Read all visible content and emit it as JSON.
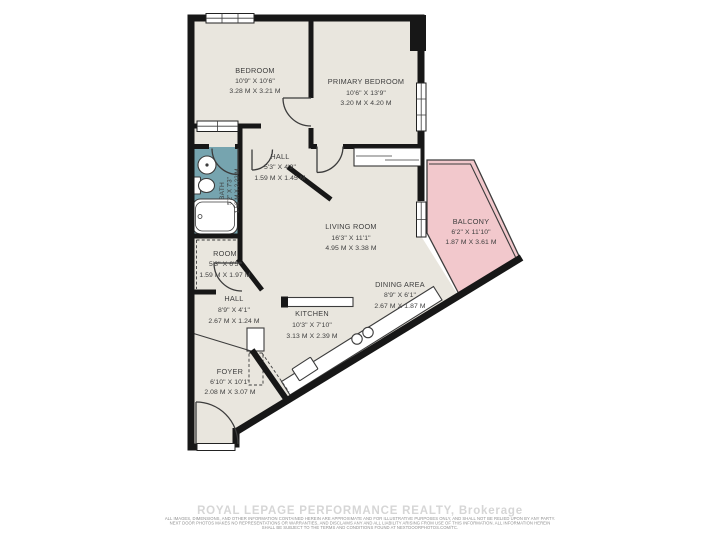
{
  "rooms": [
    {
      "id": "bedroom",
      "name": "BEDROOM",
      "imperial": "10'9\" X 10'6\"",
      "metric": "3.28 M X 3.21 M"
    },
    {
      "id": "primary-bedroom",
      "name": "PRIMARY BEDROOM",
      "imperial": "10'6\" X 13'9\"",
      "metric": "3.20 M X 4.20 M"
    },
    {
      "id": "hall-upper",
      "name": "HALL",
      "imperial": "5'3\" X 4'9\"",
      "metric": "1.59 M X 1.45 M"
    },
    {
      "id": "bath",
      "name": "BATH",
      "imperial": "5'2\" X 7'3\"",
      "metric": "1.58 M X 2.22 M"
    },
    {
      "id": "room",
      "name": "ROOM",
      "imperial": "5'3\" X 6'5\"",
      "metric": "1.59 M X 1.97 M"
    },
    {
      "id": "living-room",
      "name": "LIVING ROOM",
      "imperial": "16'3\" X 11'1\"",
      "metric": "4.95 M X 3.38 M"
    },
    {
      "id": "balcony",
      "name": "BALCONY",
      "imperial": "6'2\" X 11'10\"",
      "metric": "1.87 M X 3.61 M"
    },
    {
      "id": "dining-area",
      "name": "DINING AREA",
      "imperial": "8'9\" X 6'1\"",
      "metric": "2.67 M X 1.87 M"
    },
    {
      "id": "kitchen",
      "name": "KITCHEN",
      "imperial": "10'3\" X 7'10\"",
      "metric": "3.13 M X 2.39 M"
    },
    {
      "id": "hall-lower",
      "name": "HALL",
      "imperial": "8'9\" X 4'1\"",
      "metric": "2.67 M X 1.24 M"
    },
    {
      "id": "foyer",
      "name": "FOYER",
      "imperial": "6'10\" X 10'1\"",
      "metric": "2.08 M X 3.07 M"
    }
  ],
  "footer": {
    "brokerage": "ROYAL LEPAGE PERFORMANCE REALTY, Brokerage",
    "disclaimer_line1": "ALL IMAGES, DIMENSIONS, AND OTHER INFORMATION CONTAINED HEREIN ARE APPROXIMATE AND FOR ILLUSTRATIVE PURPOSES ONLY, AND SHALL NOT BE RELIED UPON BY ANY PARTY.",
    "disclaimer_line2": "NEXT DOOR PHOTOS MAKES NO REPRESENTATIONS OR WARRANTIES, AND DISCLAIMS ANY AND ALL LIABILITY ARISING FROM USE OF THIS INFORMATION. ALL INFORMATION HEREIN",
    "disclaimer_line3": "SHALL BE SUBJECT TO THE TERMS AND CONDITIONS FOUND AT NEXTDOORPHOTOS.COM/TC."
  },
  "colors": {
    "floor": "#e9e6de",
    "balcony": "#f2c8cc",
    "bath": "#76a4af",
    "wall": "#171717",
    "ink": "#3e3e3e",
    "brokerage": "#d6d6d6",
    "fineprint": "#8f8f8f"
  }
}
